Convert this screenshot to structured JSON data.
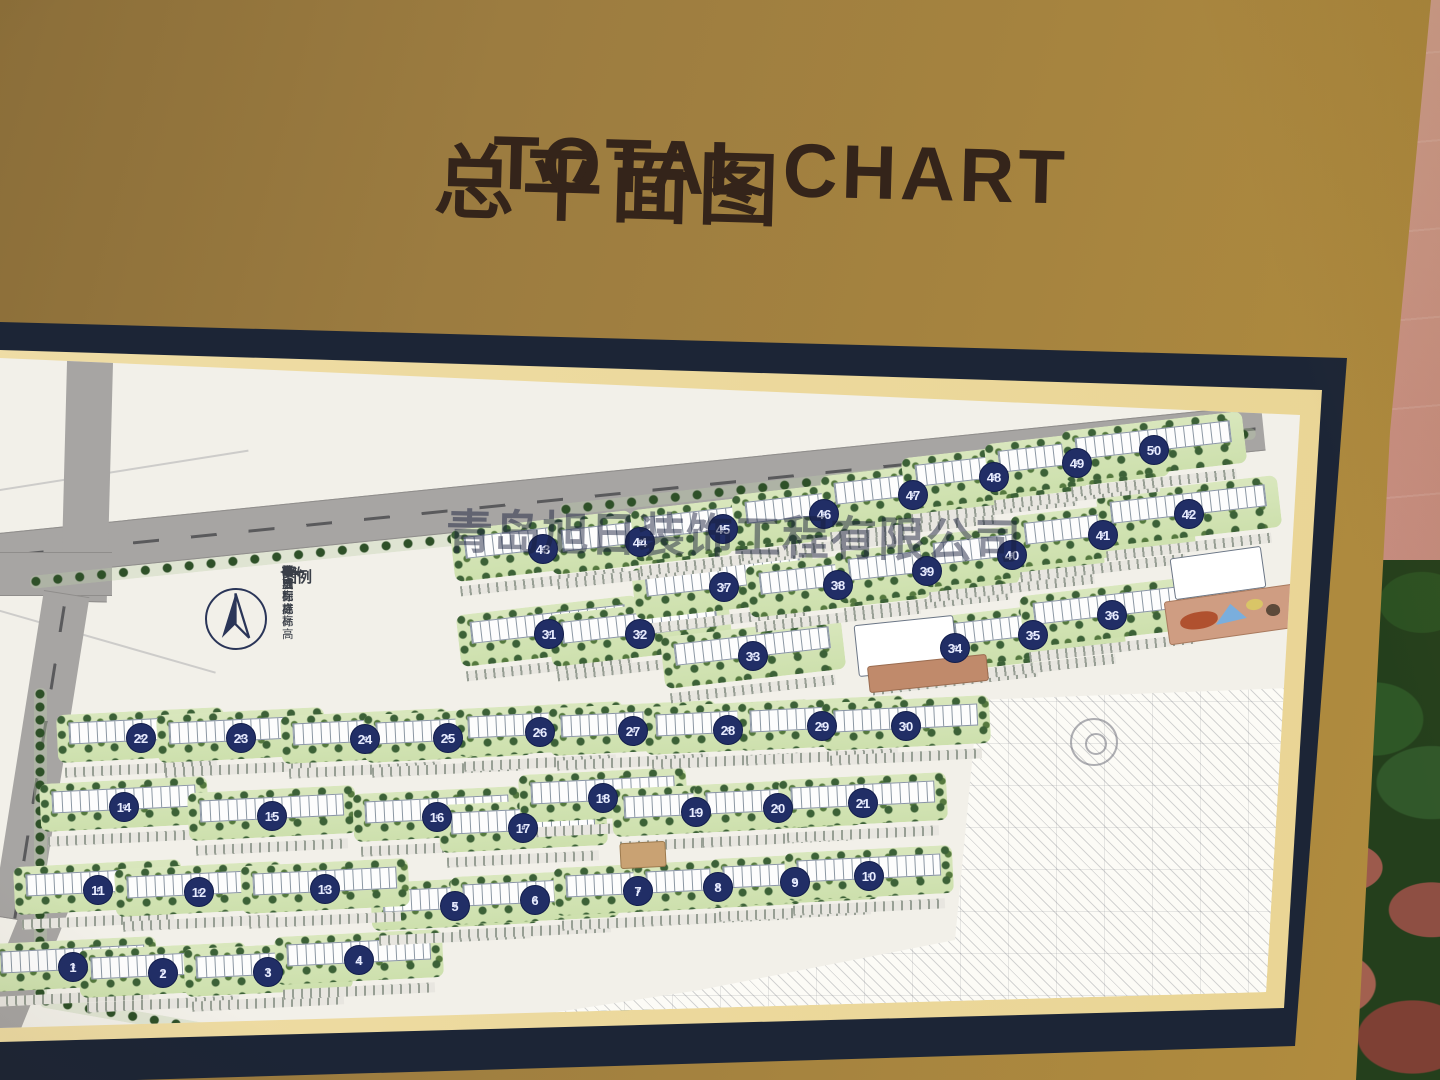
{
  "board": {
    "title_cn": "总平面图",
    "title_en": "TOTAL CHART",
    "watermark": "青岛旭日装饰工程有限公司"
  },
  "colors": {
    "board_gold": "#a5833f",
    "frame_navy": "#1c2536",
    "mat_cream": "#ecd99e",
    "paper": "#f2f0e9",
    "road_gray": "#a7a5a3",
    "strip_green": "#d5e5ba",
    "tree_green": "#3c6137",
    "circle_navy": "#212e66",
    "wall_pink": "#c98f82",
    "plaza_brown": "#c08a6b"
  },
  "map": {
    "legend": {
      "title": "图例",
      "items": [
        {
          "code": "FL",
          "label": "完成面标高"
        },
        {
          "code": "TC",
          "label": "牙石标高"
        },
        {
          "code": "TW",
          "label": "墙顶标高"
        },
        {
          "code": "TS",
          "label": "覆土完成标高"
        },
        {
          "code": "slope-symbol",
          "label": "坡度"
        }
      ]
    },
    "building_suffix": "#",
    "buildings": [
      {
        "n": 1,
        "x": 73,
        "y": 967
      },
      {
        "n": 2,
        "x": 163,
        "y": 973
      },
      {
        "n": 3,
        "x": 268,
        "y": 972
      },
      {
        "n": 4,
        "x": 359,
        "y": 960
      },
      {
        "n": 5,
        "x": 455,
        "y": 906
      },
      {
        "n": 6,
        "x": 535,
        "y": 900
      },
      {
        "n": 7,
        "x": 638,
        "y": 891
      },
      {
        "n": 8,
        "x": 718,
        "y": 887
      },
      {
        "n": 9,
        "x": 795,
        "y": 882
      },
      {
        "n": 10,
        "x": 869,
        "y": 876
      },
      {
        "n": 11,
        "x": 98,
        "y": 890
      },
      {
        "n": 12,
        "x": 199,
        "y": 892
      },
      {
        "n": 13,
        "x": 325,
        "y": 889
      },
      {
        "n": 14,
        "x": 124,
        "y": 807
      },
      {
        "n": 15,
        "x": 272,
        "y": 816
      },
      {
        "n": 16,
        "x": 437,
        "y": 817
      },
      {
        "n": 17,
        "x": 523,
        "y": 828
      },
      {
        "n": 18,
        "x": 603,
        "y": 798
      },
      {
        "n": 19,
        "x": 696,
        "y": 812
      },
      {
        "n": 20,
        "x": 778,
        "y": 808
      },
      {
        "n": 21,
        "x": 863,
        "y": 803
      },
      {
        "n": 22,
        "x": 141,
        "y": 738
      },
      {
        "n": 23,
        "x": 241,
        "y": 738
      },
      {
        "n": 24,
        "x": 365,
        "y": 739
      },
      {
        "n": 25,
        "x": 448,
        "y": 738
      },
      {
        "n": 26,
        "x": 540,
        "y": 732
      },
      {
        "n": 27,
        "x": 633,
        "y": 731
      },
      {
        "n": 28,
        "x": 728,
        "y": 730
      },
      {
        "n": 29,
        "x": 822,
        "y": 726
      },
      {
        "n": 30,
        "x": 906,
        "y": 726
      },
      {
        "n": 31,
        "x": 549,
        "y": 634
      },
      {
        "n": 32,
        "x": 640,
        "y": 634
      },
      {
        "n": 33,
        "x": 753,
        "y": 656
      },
      {
        "n": 34,
        "x": 955,
        "y": 648
      },
      {
        "n": 35,
        "x": 1033,
        "y": 635
      },
      {
        "n": 36,
        "x": 1112,
        "y": 615
      },
      {
        "n": 37,
        "x": 724,
        "y": 587
      },
      {
        "n": 38,
        "x": 838,
        "y": 585
      },
      {
        "n": 39,
        "x": 927,
        "y": 571
      },
      {
        "n": 40,
        "x": 1012,
        "y": 555
      },
      {
        "n": 41,
        "x": 1103,
        "y": 535
      },
      {
        "n": 42,
        "x": 1189,
        "y": 514
      },
      {
        "n": 43,
        "x": 543,
        "y": 549
      },
      {
        "n": 44,
        "x": 640,
        "y": 542
      },
      {
        "n": 45,
        "x": 723,
        "y": 529
      },
      {
        "n": 46,
        "x": 824,
        "y": 514
      },
      {
        "n": 47,
        "x": 913,
        "y": 495
      },
      {
        "n": 48,
        "x": 994,
        "y": 477
      },
      {
        "n": 49,
        "x": 1077,
        "y": 463
      },
      {
        "n": 50,
        "x": 1154,
        "y": 450
      }
    ],
    "facilities": [
      {
        "name": "school-building",
        "x": 856,
        "y": 620,
        "w": 100,
        "h": 52,
        "rot": -6
      },
      {
        "name": "school-plaza",
        "x": 868,
        "y": 660,
        "w": 120,
        "h": 27,
        "rot": -6
      },
      {
        "name": "kg-building",
        "x": 1172,
        "y": 552,
        "w": 92,
        "h": 42,
        "rot": -8
      },
      {
        "name": "kg-terrace",
        "x": 1166,
        "y": 592,
        "w": 138,
        "h": 44,
        "rot": -8
      },
      {
        "name": "play-red",
        "x": 1180,
        "y": 612,
        "w": 38,
        "h": 17,
        "rot": -8
      },
      {
        "name": "play-blue",
        "x": 1214,
        "y": 604,
        "w": 32,
        "h": 19,
        "rot": -8
      },
      {
        "name": "play-yellow",
        "x": 1246,
        "y": 599,
        "w": 17,
        "h": 11,
        "rot": -8
      },
      {
        "name": "play-dark",
        "x": 1266,
        "y": 604,
        "w": 14,
        "h": 12,
        "rot": -8
      },
      {
        "name": "commercial",
        "x": 620,
        "y": 842,
        "w": 46,
        "h": 26,
        "rot": -3
      }
    ]
  }
}
